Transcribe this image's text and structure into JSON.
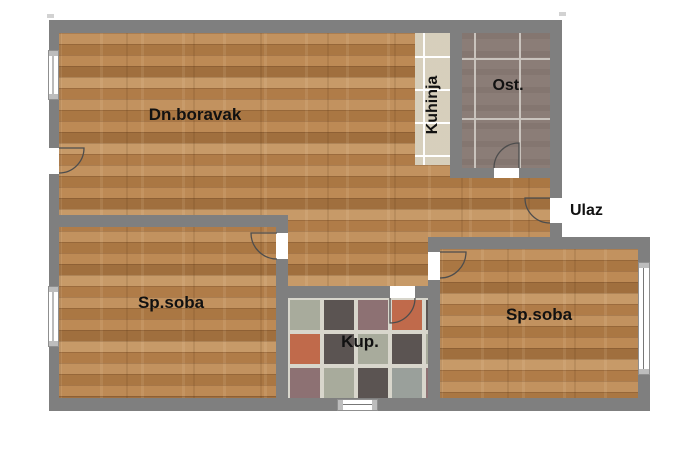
{
  "plan": {
    "type": "apartment-floorplan",
    "rooms": {
      "living": {
        "label": "Dn.boravak",
        "floor": "wood"
      },
      "kitchen": {
        "label": "Kuhinja",
        "floor": "beige-tile"
      },
      "storage": {
        "label": "Ost.",
        "floor": "gray-tile"
      },
      "entrance": {
        "label": "Ulaz",
        "floor": "outside-label"
      },
      "bedroom_left": {
        "label": "Sp.soba",
        "floor": "wood"
      },
      "bathroom": {
        "label": "Kup.",
        "floor": "mosaic-tile"
      },
      "bedroom_right": {
        "label": "Sp.soba",
        "floor": "wood"
      }
    }
  },
  "palette": {
    "wall": "#7f7f7f",
    "wood_base": "#b5834f",
    "kitchen_tile": "#e9e2d0",
    "storage_tile": "#8b7d77",
    "grout": "#d8d6cc",
    "arc_line": "#4d4d4d",
    "label": "#111111"
  },
  "bathroom_tiles": {
    "cell": 30,
    "gap": 4,
    "palette": {
      "sage": "#a8ab9c",
      "dark": "#5b5452",
      "mauve": "#8d7173",
      "terracotta": "#c06a4b",
      "plum": "#75565e",
      "gray": "#9aa09b"
    },
    "pattern": [
      [
        "sage",
        "dark",
        "mauve",
        "terracotta",
        "dark"
      ],
      [
        "terracotta",
        "dark",
        "sage",
        "dark",
        "sage"
      ],
      [
        "mauve",
        "sage",
        "dark",
        "gray",
        "mauve"
      ],
      [
        "plum",
        "mauve",
        "dark",
        "sage",
        "plum"
      ]
    ]
  }
}
